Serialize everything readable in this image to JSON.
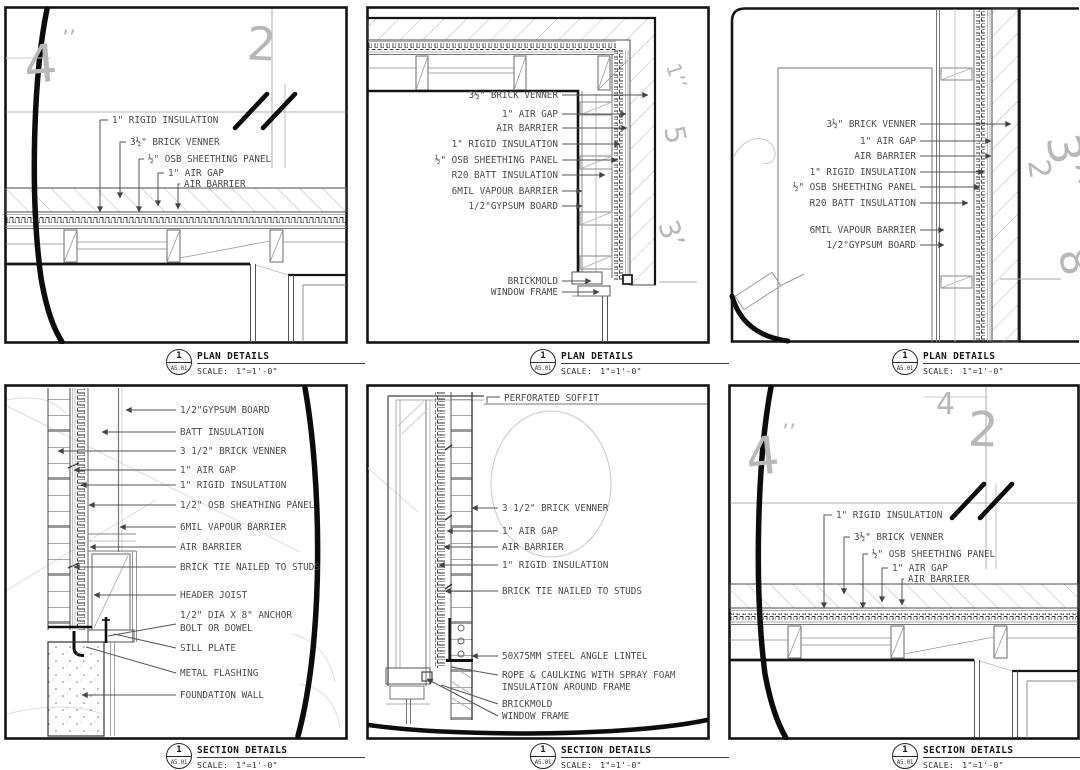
{
  "panels": [
    {
      "id": "plan-detail-a",
      "title": "PLAN DETAILS",
      "callout_number": "1",
      "callout_sheet": "A5.01",
      "scale_prefix": "SCALE:",
      "scale_value": "1\"=1'-0\"",
      "labels": [
        "1\" RIGID INSULATION",
        "3½\" BRICK VENNER",
        "½\" OSB SHEETHING PANEL",
        "1\" AIR GAP",
        "AIR BARRIER"
      ],
      "notes": [
        "4",
        "’’",
        "2"
      ]
    },
    {
      "id": "plan-detail-b",
      "title": "PLAN DETAILS",
      "callout_number": "1",
      "callout_sheet": "A5.01",
      "scale_prefix": "SCALE:",
      "scale_value": "1\"=1'-0\"",
      "labels": [
        "3½\" BRICK VENNER",
        "1\" AIR GAP",
        "AIR BARRIER",
        "1\" RIGID INSULATION",
        "½\" OSB SHEETHING PANEL",
        "R20 BATT INSULATION",
        "6MIL VAPOUR BARRIER",
        "1/2\"GYPSUM BOARD",
        "BRICKMOLD",
        "WINDOW FRAME"
      ],
      "notes": [
        "1’’",
        "5",
        "3’"
      ]
    },
    {
      "id": "plan-detail-c",
      "title": "PLAN DETAILS",
      "callout_number": "1",
      "callout_sheet": "A5.01",
      "scale_prefix": "SCALE:",
      "scale_value": "1\"=1'-0\"",
      "labels": [
        "3½\" BRICK VENNER",
        "1\" AIR GAP",
        "AIR BARRIER",
        "1\" RIGID INSULATION",
        "½\" OSB SHEETHING PANEL",
        "R20 BATT INSULATION",
        "6MIL VAPOUR BARRIER",
        "1/2\"GYPSUM BOARD"
      ],
      "notes": [
        "3’’",
        "2",
        "8’’"
      ]
    },
    {
      "id": "section-detail-a",
      "title": "SECTION DETAILS",
      "callout_number": "1",
      "callout_sheet": "A5.01",
      "scale_prefix": "SCALE:",
      "scale_value": "1\"=1'-0\"",
      "labels": [
        "1/2\"GYPSUM BOARD",
        "BATT INSULATION",
        "3 1/2\" BRICK VENNER",
        "1\" AIR GAP",
        "1\" RIGID INSULATION",
        "1/2\" OSB SHEATHING PANEL",
        "6MIL VAPOUR BARRIER",
        "AIR BARRIER",
        "BRICK TIE NAILED TO STUDS",
        "HEADER JOIST",
        "1/2\" DIA X 8\" ANCHOR",
        "BOLT OR DOWEL",
        "SILL PLATE",
        "METAL FLASHING",
        "FOUNDATION WALL"
      ],
      "notes": []
    },
    {
      "id": "section-detail-b",
      "title": "SECTION DETAILS",
      "callout_number": "1",
      "callout_sheet": "A5.01",
      "scale_prefix": "SCALE:",
      "scale_value": "1\"=1'-0\"",
      "labels": [
        "PERFORATED SOFFIT",
        "3 1/2\" BRICK VENNER",
        "1\" AIR GAP",
        "AIR BARRIER",
        "1\" RIGID INSULATION",
        "BRICK TIE NAILED TO STUDS",
        "50X75MM STEEL ANGLE LINTEL",
        "ROPE & CAULKING WITH SPRAY FOAM",
        "INSULATION AROUND FRAME",
        "BRICKMOLD",
        "WINDOW FRAME"
      ],
      "notes": []
    },
    {
      "id": "section-detail-c",
      "title": "SECTION DETAILS",
      "callout_number": "1",
      "callout_sheet": "A5.01",
      "scale_prefix": "SCALE:",
      "scale_value": "1\"=1'-0\"",
      "labels": [
        "1\" RIGID INSULATION",
        "3½\" BRICK VENNER",
        "½\" OSB SHEETHING PANEL",
        "1\" AIR GAP",
        "AIR BARRIER"
      ],
      "notes": [
        "4",
        "’’",
        "4",
        "2"
      ]
    }
  ]
}
